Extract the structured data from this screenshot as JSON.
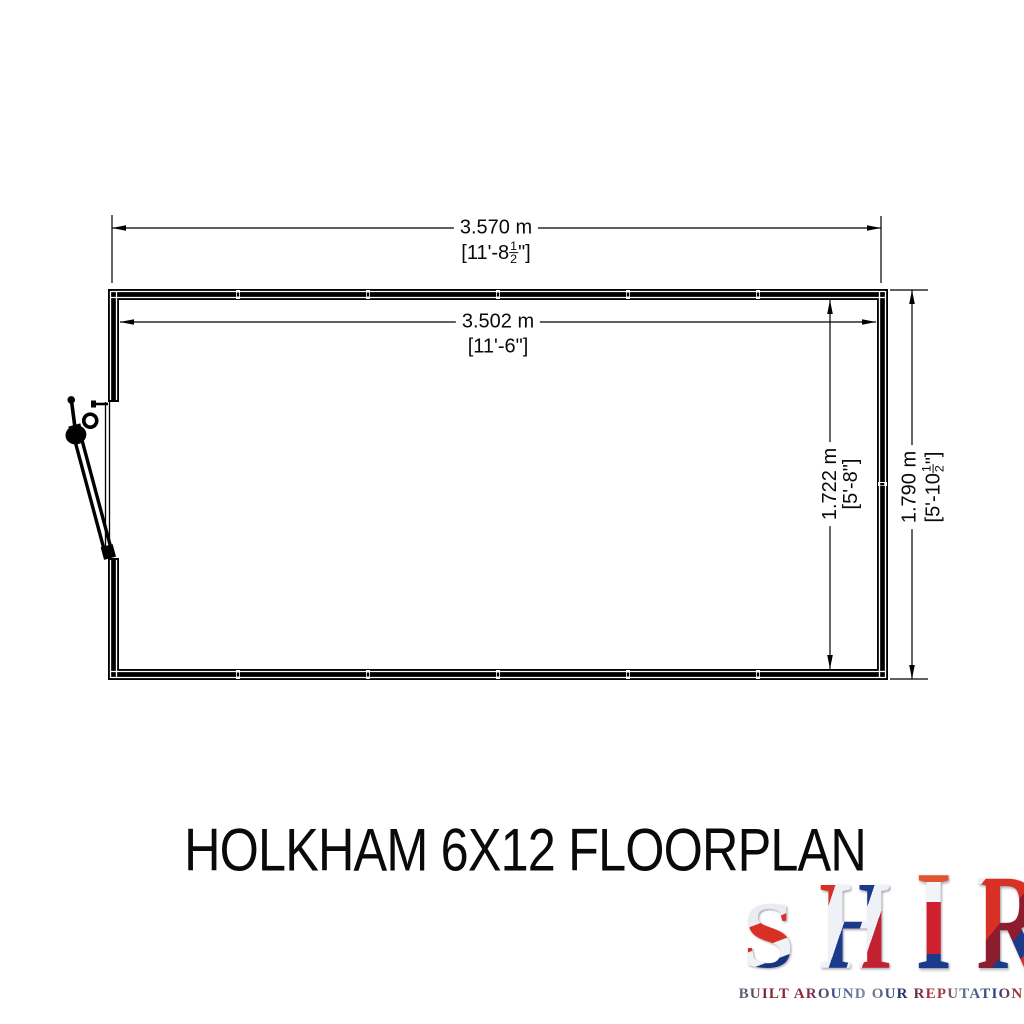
{
  "title": "HOLKHAM 6X12 FLOORPLAN",
  "dims": {
    "outer_width": {
      "metric": "3.570 m",
      "imp_pre": "[11'-8",
      "frac_num": "1",
      "frac_den": "2",
      "imp_post": "\"]"
    },
    "inner_width": {
      "metric": "3.502 m",
      "imperial": "[11'-6\"]"
    },
    "inner_depth": {
      "metric": "1.722 m",
      "imperial": "[5'-8\"]"
    },
    "outer_depth": {
      "metric": "1.790 m",
      "imp_pre": "[5'-10",
      "frac_num": "1",
      "frac_den": "2",
      "imp_post": "\"]"
    }
  },
  "drawing": {
    "line_color": "#000000",
    "wall_fill": "#000000",
    "background": "#ffffff",
    "elements": [
      "top-wall",
      "bottom-wall",
      "left-wall-with-door-opening",
      "right-wall",
      "open-door-leaf",
      "door-handle"
    ]
  },
  "brand": {
    "letters": [
      "S",
      "H",
      "I",
      "R",
      "E"
    ],
    "tagline": "BUILT AROUND OUR REPUTATION",
    "colors": {
      "red": "#c8102e",
      "navy": "#1b2f6e",
      "silver": "#dfe5ec"
    }
  }
}
